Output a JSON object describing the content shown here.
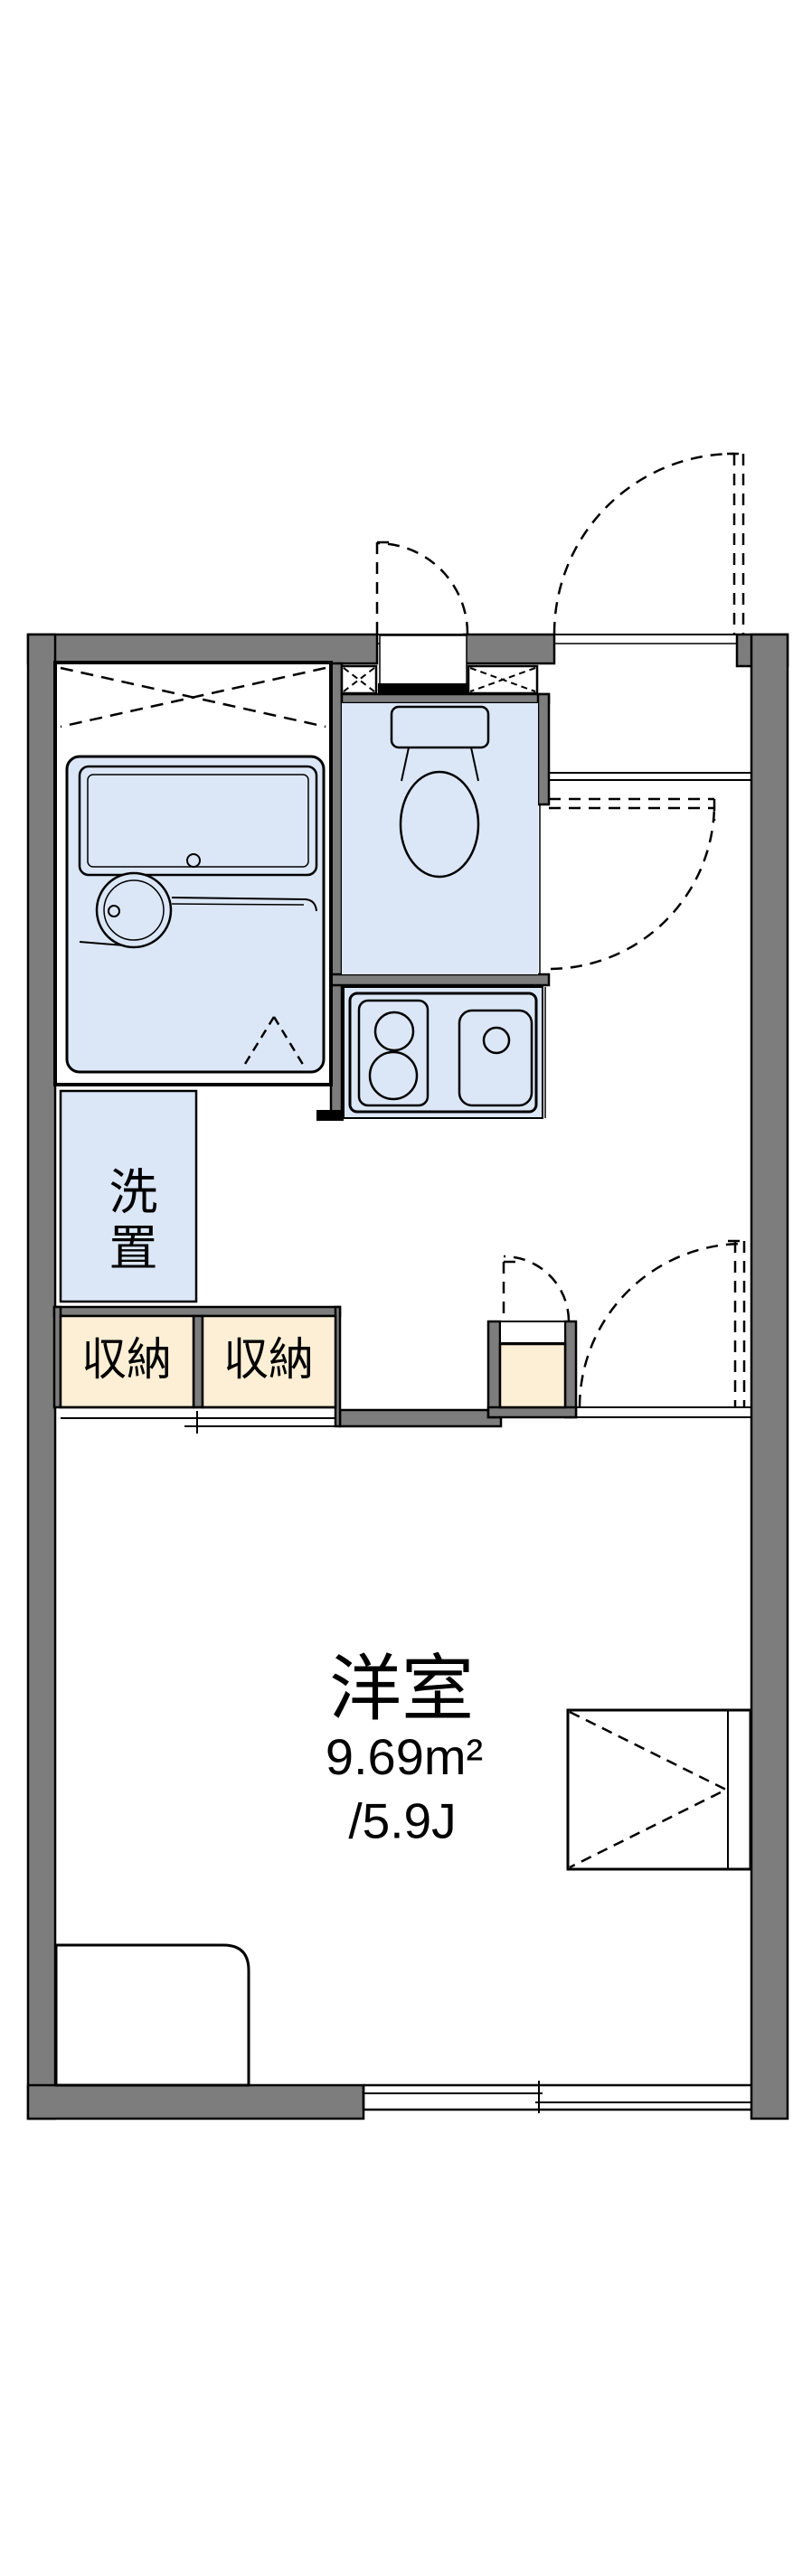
{
  "colors": {
    "wall": "#7d7d7d",
    "water_fixture": "#dbe7f7",
    "storage": "#fcefd5",
    "line": "#000000",
    "background": "#ffffff"
  },
  "labels": {
    "laundry": "洗置",
    "storage_left": "収納",
    "storage_right": "収納",
    "main_room_name": "洋室",
    "main_room_area": "9.69m²",
    "main_room_tatami": "/5.9J"
  }
}
